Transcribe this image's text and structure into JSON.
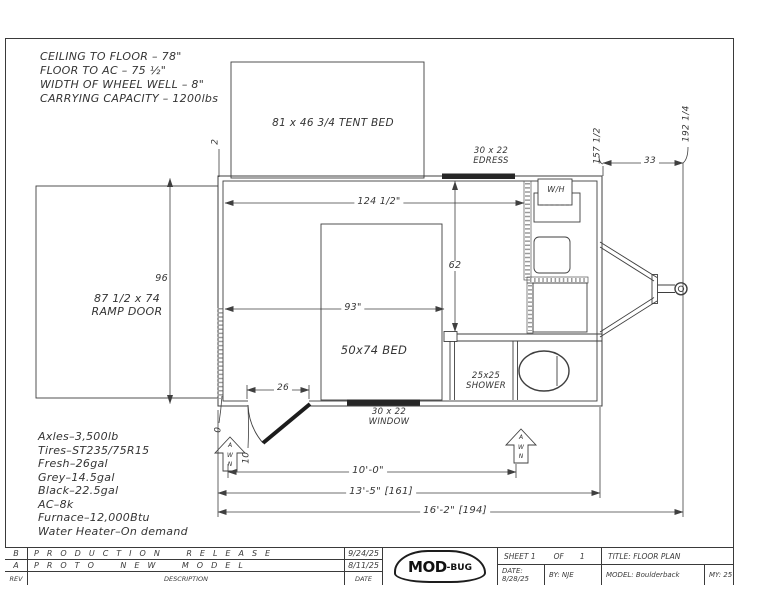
{
  "top_notes": [
    "CEILING TO FLOOR – 78\"",
    "FLOOR TO AC – 75 ½\"",
    "WIDTH OF WHEEL WELL – 8\"",
    "CARRYING CAPACITY – 1200lbs"
  ],
  "spec_notes": [
    "Axles–3,500lb",
    "Tires–ST235/75R15",
    "Fresh–26gal",
    "Grey–14.5gal",
    "Black–22.5gal",
    "AC–8k",
    "Furnace–12,000Btu",
    "Water Heater–On demand"
  ],
  "labels": {
    "tent_bed": "81 x 46 3/4 TENT BED",
    "egress_size": "30 x 22",
    "egress_name": "EDRESS",
    "window_size": "30 x 22",
    "window_name": "WINDOW",
    "water_heater": "W/H",
    "bed": "50x74 BED",
    "shower_size": "25x25",
    "shower_name": "SHOWER",
    "ramp_size": "87 1/2 x 74",
    "ramp_name": "RAMP DOOR",
    "awning": "A\nW\nN"
  },
  "dimensions": {
    "interior_length": "124 1/2\"",
    "body_width": "96",
    "front_to_bath": "62",
    "bed_wall": "93\"",
    "door_opening": "26",
    "wall_thickness": "2",
    "door_offset_a": "0",
    "door_offset_b": "10",
    "awning_length": "10'-0\"",
    "box_length": "13'-5\" [161]",
    "overall_length": "16'-2\" [194]",
    "tongue_length": "33",
    "body_length": "157 1/2",
    "total_length": "192 1/4"
  },
  "title_block": {
    "revisions": [
      {
        "rev": "B",
        "description": "PRODUCTION RELEASE",
        "date": "9/24/25"
      },
      {
        "rev": "A",
        "description": "PROTO NEW MODEL",
        "date": "8/11/25"
      }
    ],
    "columns": {
      "rev": "REV",
      "description": "DESCRIPTION",
      "date": "DATE"
    },
    "logo": {
      "main": "MOD",
      "sub": "-BUG"
    },
    "sheet": {
      "label": "SHEET 1",
      "of": "OF",
      "value": "1"
    },
    "title": "TITLE: FLOOR PLAN",
    "date": "DATE: 8/28/25",
    "by": "BY: NJE",
    "model": "MODEL: Boulderback",
    "model_year": "MY: 25"
  }
}
